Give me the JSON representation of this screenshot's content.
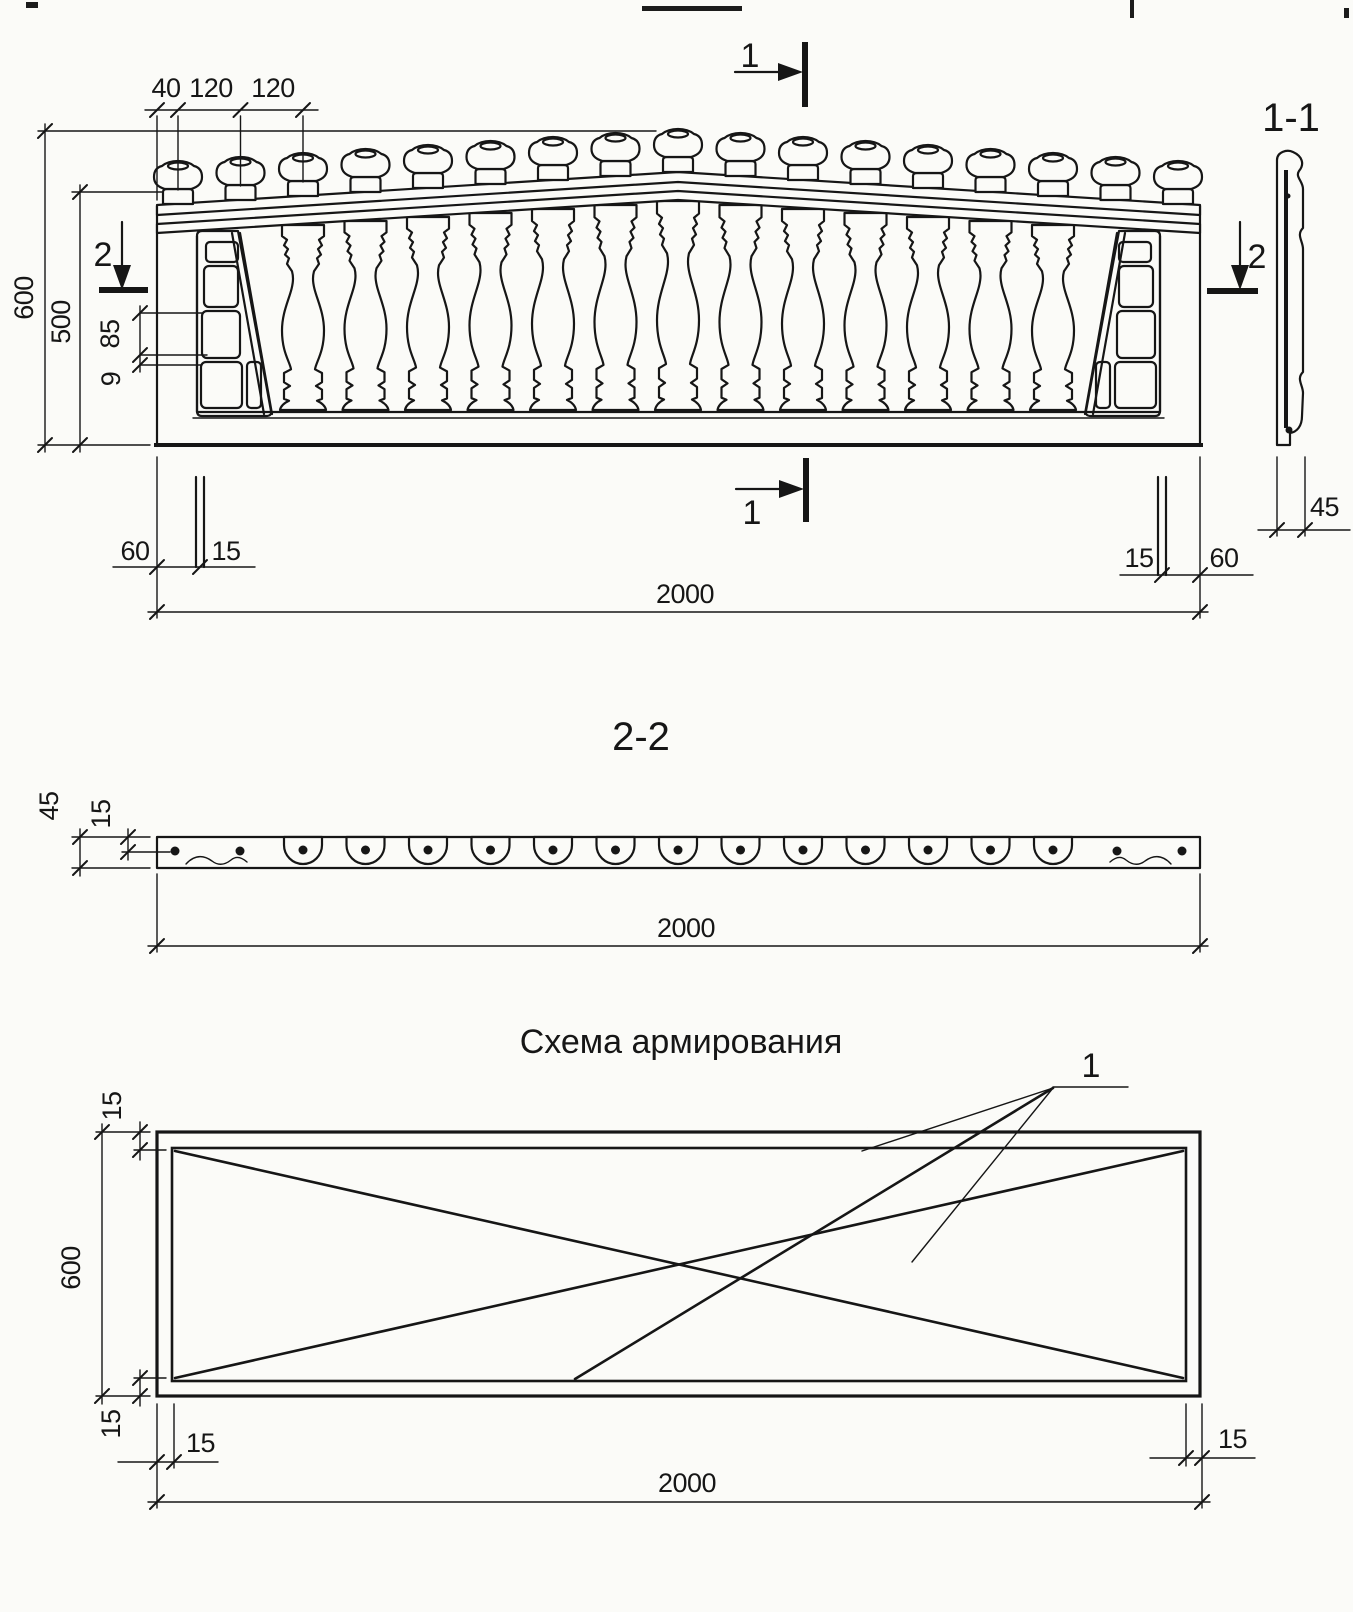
{
  "colors": {
    "ink": "#161616",
    "paper": "#fbfbf8"
  },
  "front_view": {
    "top_dims": {
      "d40": "40",
      "d120a": "120",
      "d120b": "120"
    },
    "left_dims": {
      "d600": "600",
      "d500": "500"
    },
    "detail_dims": {
      "d85": "85",
      "d9": "9"
    },
    "bottom_dims": {
      "d60_left": "60",
      "d15_left": "15",
      "d15_right": "15",
      "d60_right": "60",
      "d2000": "2000"
    },
    "markers": {
      "m1_top": "1",
      "m1_bottom": "1",
      "m2_left": "2",
      "m2_right": "2"
    }
  },
  "section_1_1": {
    "title": "1-1",
    "d45": "45"
  },
  "section_2_2": {
    "title": "2-2",
    "d45": "45",
    "d15": "15",
    "d2000": "2000"
  },
  "reinforcement": {
    "title": "Схема армирования",
    "bar_label": "1",
    "d15_top": "15",
    "d600": "600",
    "d15_bottom": "15",
    "d15_bottom_left": "15",
    "d15_bottom_right": "15",
    "d2000": "2000"
  }
}
